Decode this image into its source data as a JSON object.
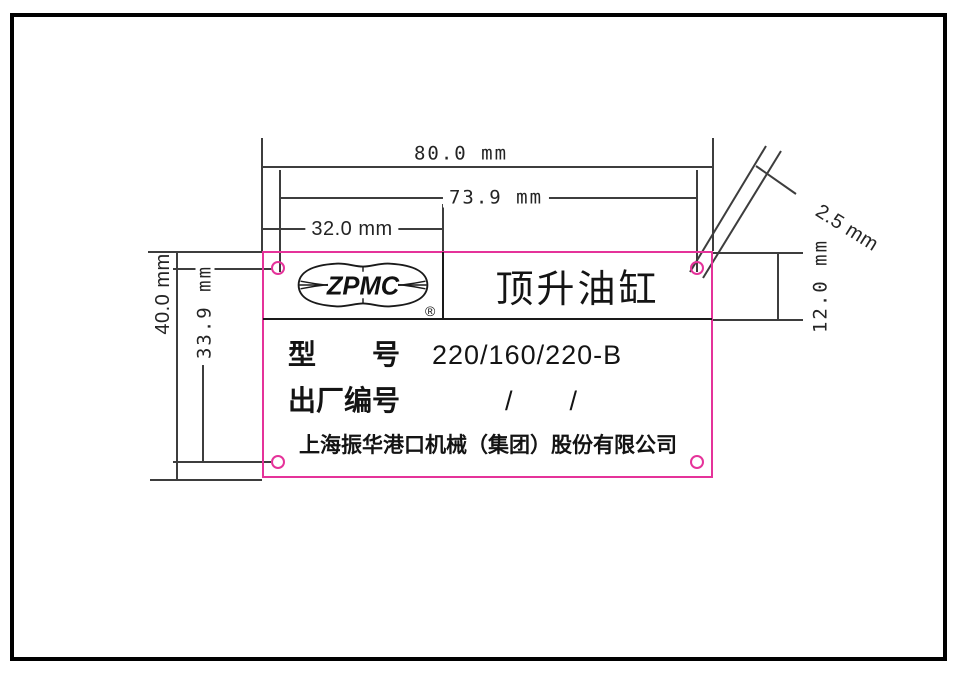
{
  "plate": {
    "product_name": "顶升油缸",
    "logo_text": "ZPMC",
    "registered_mark": "®",
    "model_label": "型　　号",
    "model_value": "220/160/220-B",
    "serial_label": "出厂编号",
    "serial_value": "/　　/",
    "company": "上海振华港口机械（集团）股份有限公司",
    "outline_color": "#e5339a"
  },
  "dimensions": {
    "overall_width": "80.0 mm",
    "hole_span_width": "73.9 mm",
    "logo_cell_width": "32.0 mm",
    "overall_height": "40.0 mm",
    "hole_span_height": "33.9 mm",
    "band_height": "12.0 mm",
    "hole_diameter": "2.5 mm"
  },
  "colors": {
    "dimension_lines": "#3d3d3d",
    "plate_outline": "#e5339a",
    "ink": "#141414"
  }
}
